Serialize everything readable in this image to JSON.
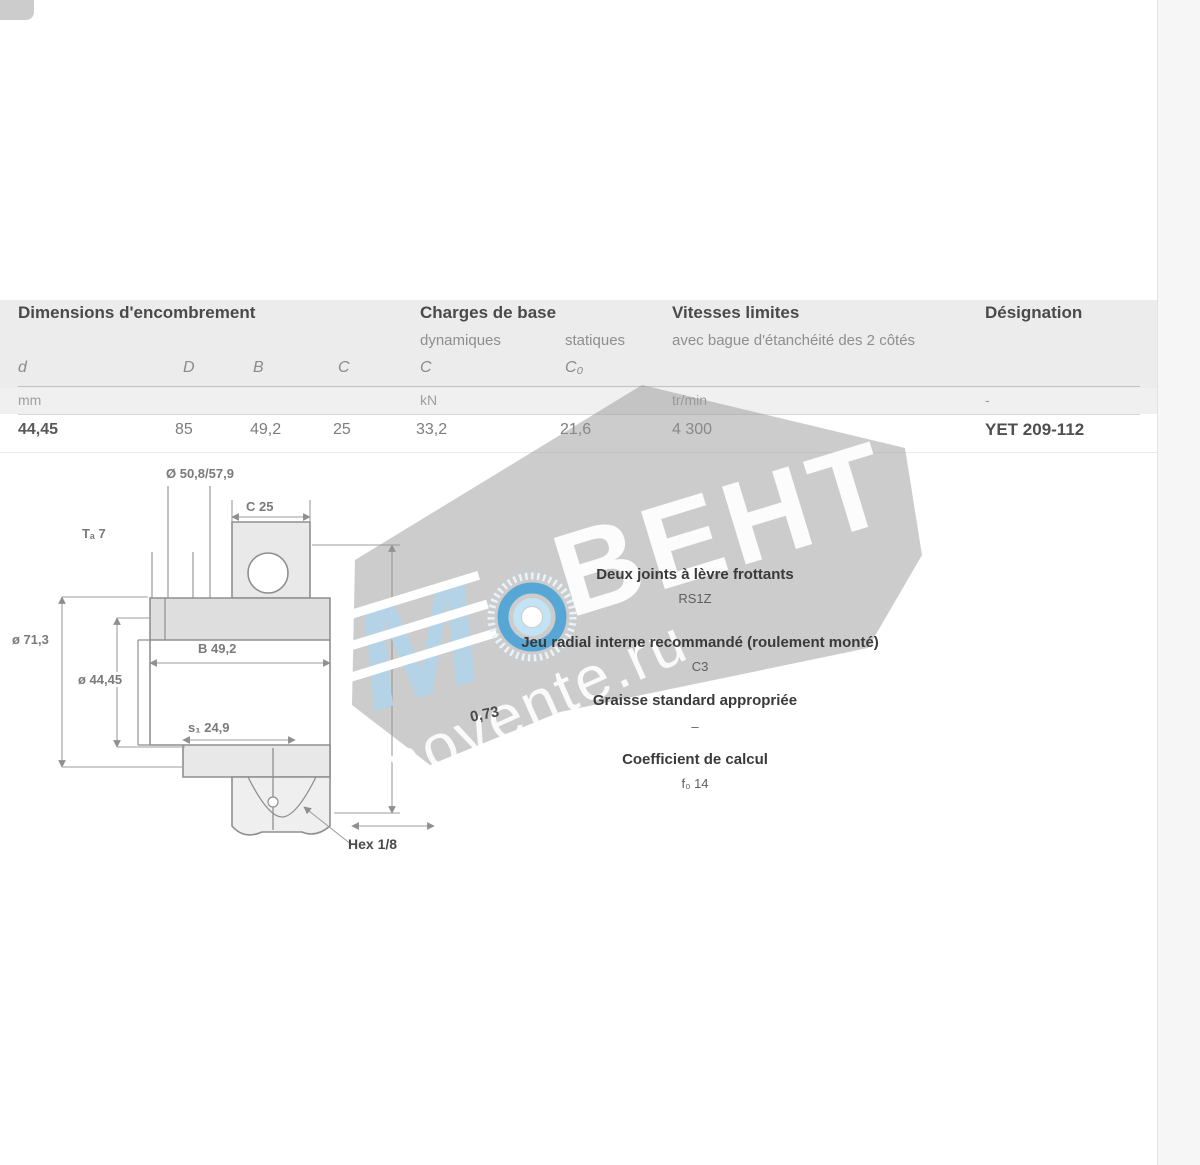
{
  "table": {
    "group_headers": {
      "dimensions": "Dimensions d'encombrement",
      "loads": "Charges de base",
      "speeds": "Vitesses limites",
      "designation": "Désignation"
    },
    "sub_headers": {
      "dynamic": "dynamiques",
      "static": "statiques",
      "speed_note": "avec bague d'étanchéité des 2 côtés"
    },
    "symbols": {
      "d": "d",
      "D": "D",
      "B": "B",
      "C": "C",
      "C_dyn": "C",
      "C0": "C₀"
    },
    "units": {
      "dimensions": "mm",
      "loads": "kN",
      "speeds": "tr/min",
      "designation": "-"
    },
    "row": {
      "d": "44,45",
      "D": "85",
      "B": "49,2",
      "C": "25",
      "C_dyn": "33,2",
      "C0": "21,6",
      "speed": "4 300",
      "designation": "YET 209-112"
    }
  },
  "drawing": {
    "labels": {
      "top_diameters": "Ø 50,8/57,9",
      "outer_width": "C 25",
      "ta": "Tₐ 7",
      "outer_diameter": "ø 71,3",
      "bore_diameter": "ø 44,45",
      "ring_width": "B 49,2",
      "s1": "s₁ 24,9",
      "hex": "Hex 1/8",
      "mass": "0,73"
    }
  },
  "specs": {
    "items": [
      {
        "label": "Deux joints à lèvre frottants",
        "value": "RS1Z"
      },
      {
        "label": "Jeu radial interne recommandé (roulement monté)",
        "value": "C3"
      },
      {
        "label": "Graisse standard appropriée",
        "value": "–"
      },
      {
        "label": "Coefficient de calcul",
        "value": "f₀ 14"
      }
    ]
  },
  "watermark": {
    "brand": "ВЕНТ",
    "site": "movente.ru",
    "logo_letter": "M"
  }
}
